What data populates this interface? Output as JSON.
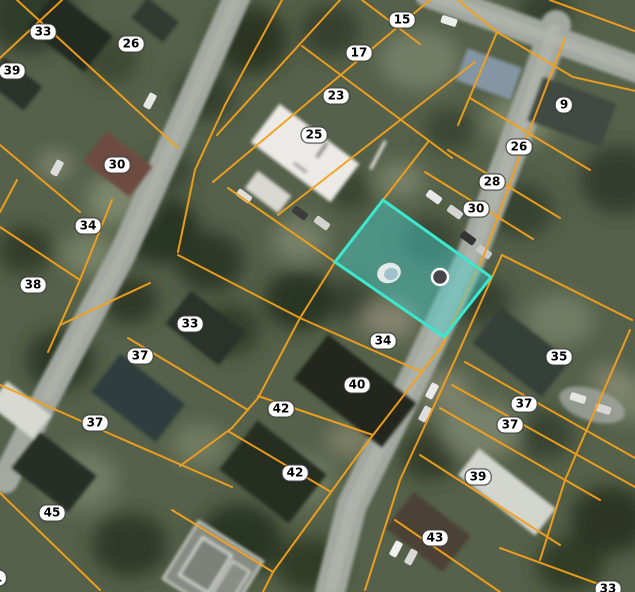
{
  "map": {
    "type": "aerial-parcel-map",
    "parcel_labels": [
      {
        "text": "33",
        "x": 43,
        "y": 32
      },
      {
        "text": "26",
        "x": 131,
        "y": 44
      },
      {
        "text": "39",
        "x": 12,
        "y": 71
      },
      {
        "text": "30",
        "x": 117,
        "y": 165
      },
      {
        "text": "34",
        "x": 88,
        "y": 226
      },
      {
        "text": "38",
        "x": 33,
        "y": 285
      },
      {
        "text": "15",
        "x": 402,
        "y": 20
      },
      {
        "text": "17",
        "x": 359,
        "y": 53
      },
      {
        "text": "23",
        "x": 336,
        "y": 96
      },
      {
        "text": "25",
        "x": 314,
        "y": 135
      },
      {
        "text": "9",
        "x": 564,
        "y": 105
      },
      {
        "text": "26",
        "x": 519,
        "y": 147
      },
      {
        "text": "28",
        "x": 492,
        "y": 182
      },
      {
        "text": "30",
        "x": 476,
        "y": 209
      },
      {
        "text": "33",
        "x": 190,
        "y": 324
      },
      {
        "text": "37",
        "x": 140,
        "y": 356
      },
      {
        "text": "37",
        "x": 95,
        "y": 423
      },
      {
        "text": "45",
        "x": 52,
        "y": 513
      },
      {
        "text": "34",
        "x": 383,
        "y": 341
      },
      {
        "text": "40",
        "x": 357,
        "y": 385
      },
      {
        "text": "42",
        "x": 281,
        "y": 409
      },
      {
        "text": "42",
        "x": 295,
        "y": 473
      },
      {
        "text": "35",
        "x": 559,
        "y": 357
      },
      {
        "text": "37",
        "x": 524,
        "y": 404
      },
      {
        "text": "37",
        "x": 510,
        "y": 425
      },
      {
        "text": "39",
        "x": 478,
        "y": 477
      },
      {
        "text": "43",
        "x": 435,
        "y": 538
      },
      {
        "text": "33",
        "x": 608,
        "y": 589
      },
      {
        "text": "1",
        "x": -2,
        "y": 578
      }
    ],
    "highlighted_parcel": {
      "points": "383,200 491,277 444,337 335,262",
      "has_pool": true,
      "has_point_marker": true
    },
    "colors": {
      "parcel_line": "#F5A11B",
      "highlight_fill": "rgba(72,209,204,0.45)",
      "highlight_stroke": "#3BE8CF",
      "label_bg": "#FFFFFF",
      "label_text": "#000000",
      "road": "#A3A8A0"
    }
  }
}
